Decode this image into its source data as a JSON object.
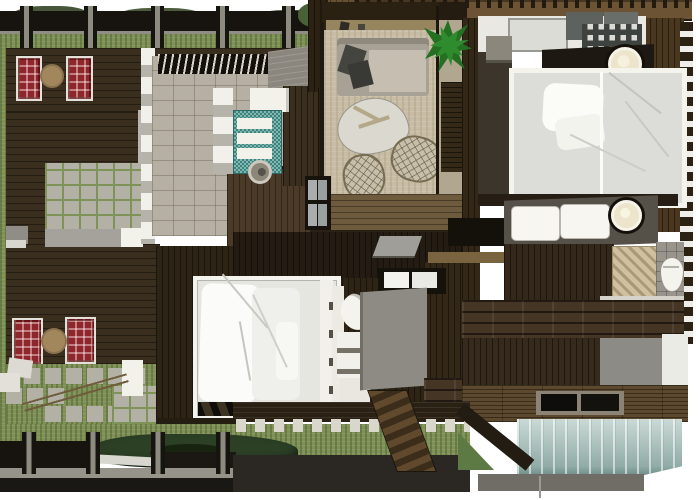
{
  "scene": {
    "title": "Tropical villa floor plan — top-down 3D render",
    "type": "architectural-top-view-render",
    "rooms": [
      {
        "name": "outdoor-deck-west",
        "features": [
          "pergola with posts",
          "two pairs of red plaid lounge chairs",
          "round wooden side tables",
          "teal plunge pool with sculpture",
          "paver patio",
          "stepping-stone path",
          "garden pond",
          "white planters"
        ]
      },
      {
        "name": "spa-room",
        "features": [
          "slatted bamboo roof",
          "stone tile floor",
          "teal mosaic soaking tub with white steps",
          "round wash basin",
          "white column wall",
          "dark slatted cabinet"
        ]
      },
      {
        "name": "living-room",
        "features": [
          "gray sofa with dark pillows",
          "organic white coffee table",
          "two wicker armchairs",
          "beige rug",
          "green potted plant",
          "glass wall"
        ]
      },
      {
        "name": "bedroom-east",
        "features": [
          "white canopy bed",
          "dark counter with cream vessel sink",
          "skylight panels",
          "window-grid wall",
          "nightstand"
        ]
      },
      {
        "name": "bedroom-south",
        "features": [
          "white canopy bed with drapes",
          "white door panel",
          "white curved lounge chair",
          "white storage shelves",
          "gray concrete wall panel",
          "two windows"
        ]
      },
      {
        "name": "bathroom-east",
        "features": [
          "dark vanity with two white sinks",
          "cream vessel sink",
          "white toilet",
          "diagonal-weave bath mat",
          "gray tile floor"
        ]
      },
      {
        "name": "rear-deck-southeast",
        "features": [
          "plank decking",
          "black skylight hatch",
          "frosted teal glass wall",
          "wooden stair ramp",
          "concrete wall"
        ]
      }
    ],
    "palette": {
      "bg": "#ffffff",
      "deck": "#3a2f1f",
      "deckmid": "#4a3a27",
      "wall": "#2c2213",
      "floorwood": "#6e5a3c",
      "beam": "#17140f",
      "grass": "#7f9156",
      "grassdk": "#5d7a44",
      "paver": "#b3b0a5",
      "stone": "#b6b0a4",
      "teal": "#4f9b93",
      "glass": "#b9cdc8",
      "rug": "#c8bda4",
      "sofa": "#a8a196",
      "white": "#f2f1ea",
      "red": "#8f262b",
      "tan": "#a3875c",
      "concrete": "#8d8b85",
      "pond": "#2c4026",
      "plant": "#2f8c2e",
      "cream": "#ece5cb",
      "graytile": "#99958d"
    }
  }
}
